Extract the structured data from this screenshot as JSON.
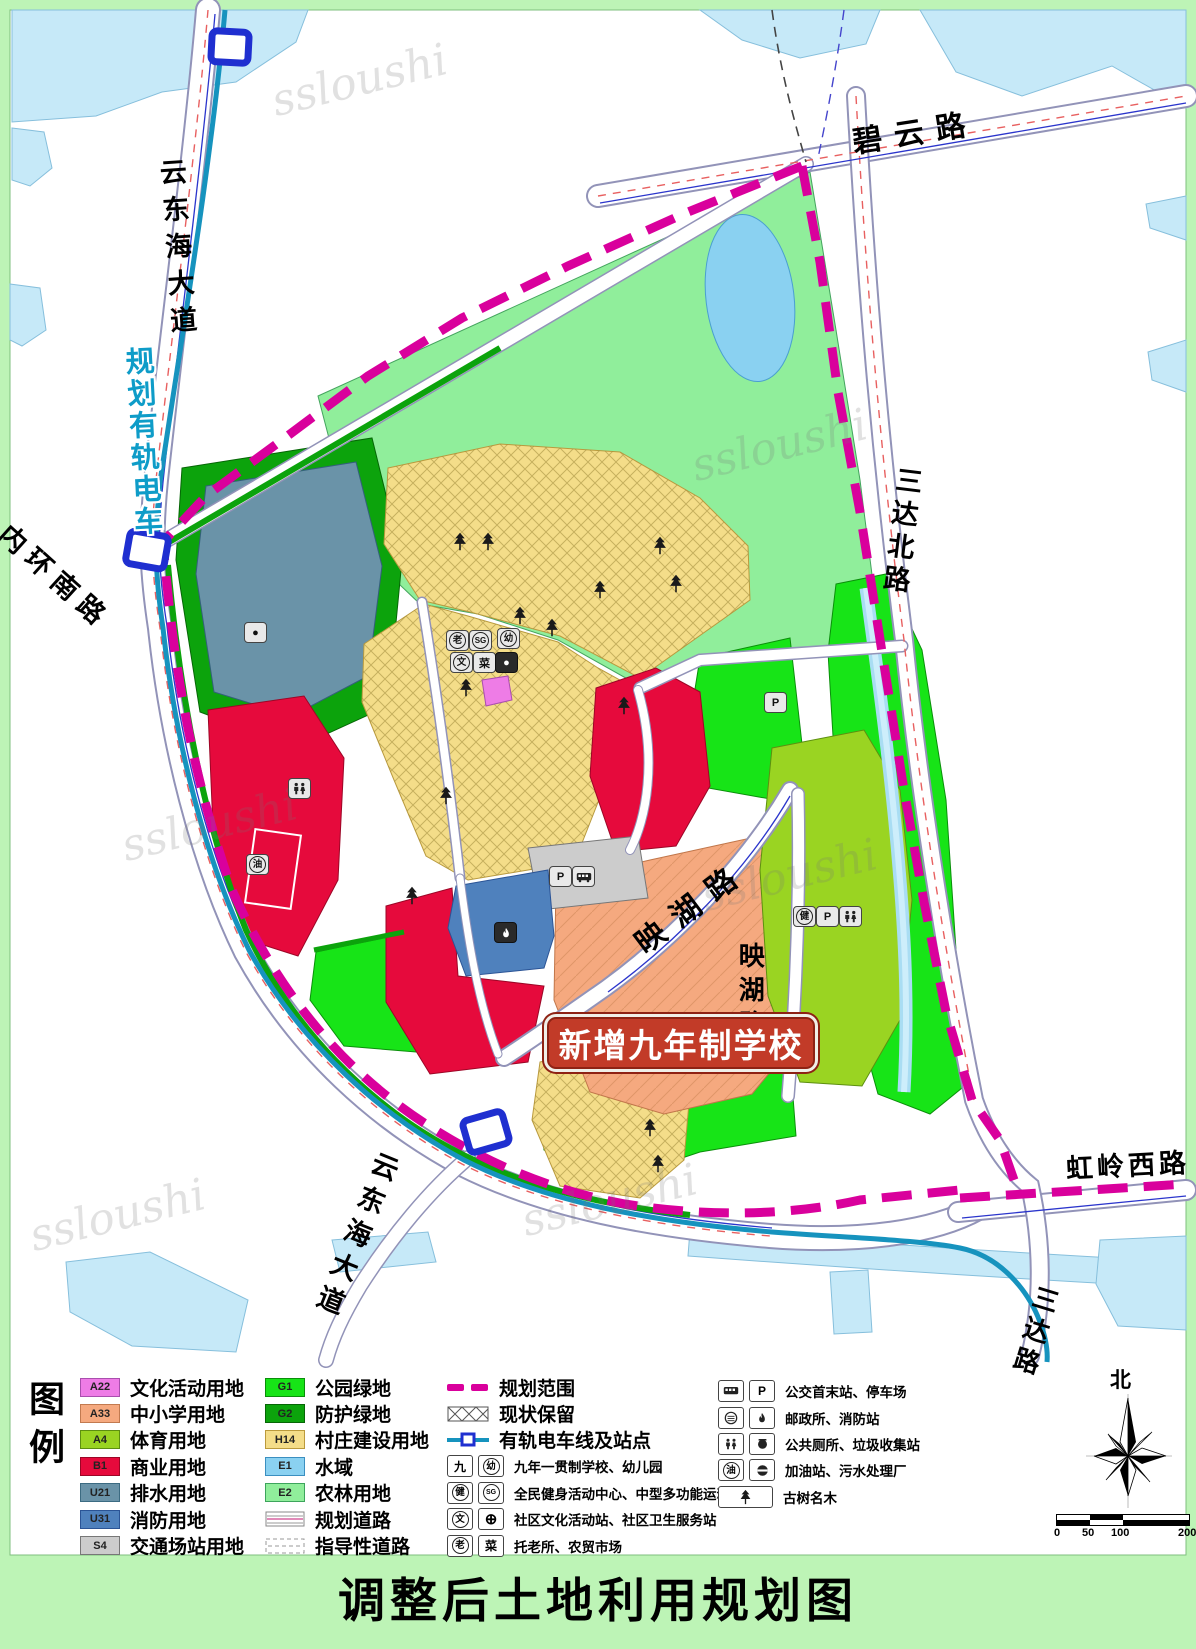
{
  "watermark": {
    "text": "ssloushi"
  },
  "page_title": "调整后土地利用规划图",
  "map": {
    "callout": {
      "text": "新增九年制学校",
      "bg": "#c23b28"
    },
    "labels": {
      "biyun": "碧云路",
      "yundonghai_north": "云东海大道",
      "tram_planned": "规划有轨电车",
      "neihuan_south": "内环南路",
      "sanda_north": "三达北路",
      "yinghu_diagonal": "映湖路",
      "yinghu_vertical": "映湖路",
      "yundonghai_south": "云东海大道",
      "hongling_west": "虹岭西路",
      "sanda_south": "三达路",
      "north": "北"
    },
    "scale_ticks": [
      "0",
      "50",
      "100",
      "200"
    ],
    "icon_glyphs": {
      "parking": "P",
      "fitness": "健",
      "gas": "油",
      "culture": "文",
      "market": "菜",
      "kindergarten": "幼",
      "elder": "老",
      "sports_ground": "SG",
      "nine_year_school": "九",
      "dot": "●",
      "health_cross": "⊕"
    },
    "colors": {
      "boundary": "#d9009c",
      "tram": "#1693be",
      "station": "#1f2fd0"
    }
  },
  "legend": {
    "heading": "图例",
    "col1": [
      {
        "code": "A22",
        "label": "文化活动用地",
        "color": "#ee7ce6",
        "border": "#a94fae"
      },
      {
        "code": "A33",
        "label": "中小学用地",
        "color": "#f5a97f",
        "border": "#c27a50"
      },
      {
        "code": "A4",
        "label": "体育用地",
        "color": "#9ad422",
        "border": "#5d8f10"
      },
      {
        "code": "B1",
        "label": "商业用地",
        "color": "#e60a3c",
        "border": "#9c0626"
      },
      {
        "code": "U21",
        "label": "排水用地",
        "color": "#6a93a8",
        "border": "#3c6b82"
      },
      {
        "code": "U31",
        "label": "消防用地",
        "color": "#4f81bd",
        "border": "#2b5496"
      },
      {
        "code": "S4",
        "label": "交通场站用地",
        "color": "#cccccc",
        "border": "#777777"
      }
    ],
    "col2": [
      {
        "code": "G1",
        "label": "公园绿地",
        "color": "#17e417",
        "border": "#0a8f0a"
      },
      {
        "code": "G2",
        "label": "防护绿地",
        "color": "#0ca30c",
        "border": "#066606"
      },
      {
        "code": "H14",
        "label": "村庄建设用地",
        "color": "#f4dd89",
        "border": "#bb9a3c"
      },
      {
        "code": "E1",
        "label": "水域",
        "color": "#8ad1f1",
        "border": "#3b8fc0"
      },
      {
        "code": "E2",
        "label": "农林用地",
        "color": "#90ee9b",
        "border": "#3da45c"
      },
      {
        "label": "规划道路"
      },
      {
        "label": "指导性道路"
      }
    ],
    "col3": [
      {
        "label": "规划范围"
      },
      {
        "label": "现状保留"
      },
      {
        "label": "有轨电车线及站点"
      },
      {
        "icon1": "九",
        "icon2": "幼",
        "label": "九年一贯制学校、幼儿园"
      },
      {
        "icon1": "健",
        "icon2": "SG",
        "label": "全民健身活动中心、中型多功能运动场"
      },
      {
        "icon1": "文",
        "icon2": "⊕",
        "label": "社区文化活动站、社区卫生服务站"
      },
      {
        "icon1": "老",
        "icon2": "菜",
        "label": "托老所、农贸市场"
      }
    ],
    "col4": [
      {
        "label": "公交首末站、停车场"
      },
      {
        "label": "邮政所、消防站"
      },
      {
        "label": "公共厕所、垃圾收集站"
      },
      {
        "label": "加油站、污水处理厂"
      },
      {
        "label": "古树名木"
      }
    ]
  }
}
